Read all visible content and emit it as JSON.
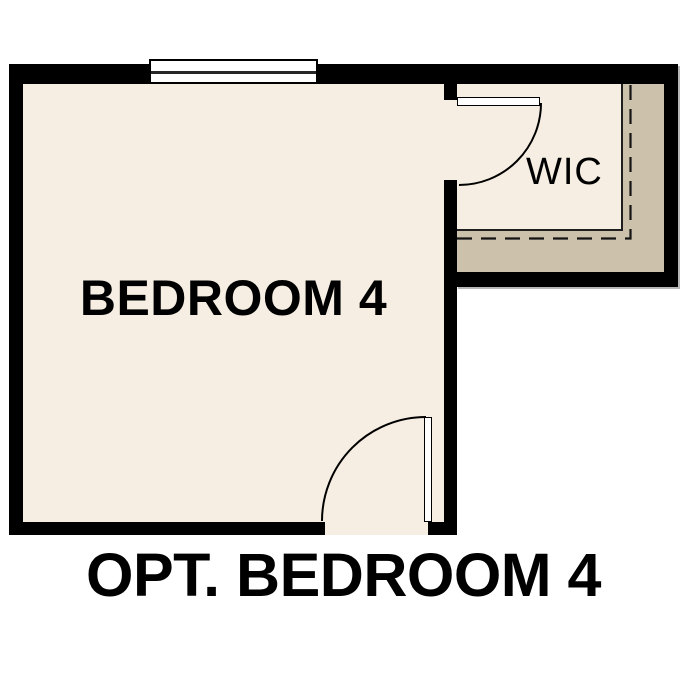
{
  "plan": {
    "caption": "OPT. BEDROOM 4",
    "rooms": [
      {
        "label": "BEDROOM 4"
      },
      {
        "label": "WIC"
      }
    ],
    "features": [
      "window-on-top-wall",
      "bedroom-door-swing-bottom-wall",
      "wic-door-swing",
      "optional-area-dashed-outline"
    ],
    "colors": {
      "wall": "#000000",
      "floor": "#F6EEE2",
      "optional_area": "#CCC1AA",
      "background": "#FFFFFF",
      "text": "#000000"
    }
  }
}
